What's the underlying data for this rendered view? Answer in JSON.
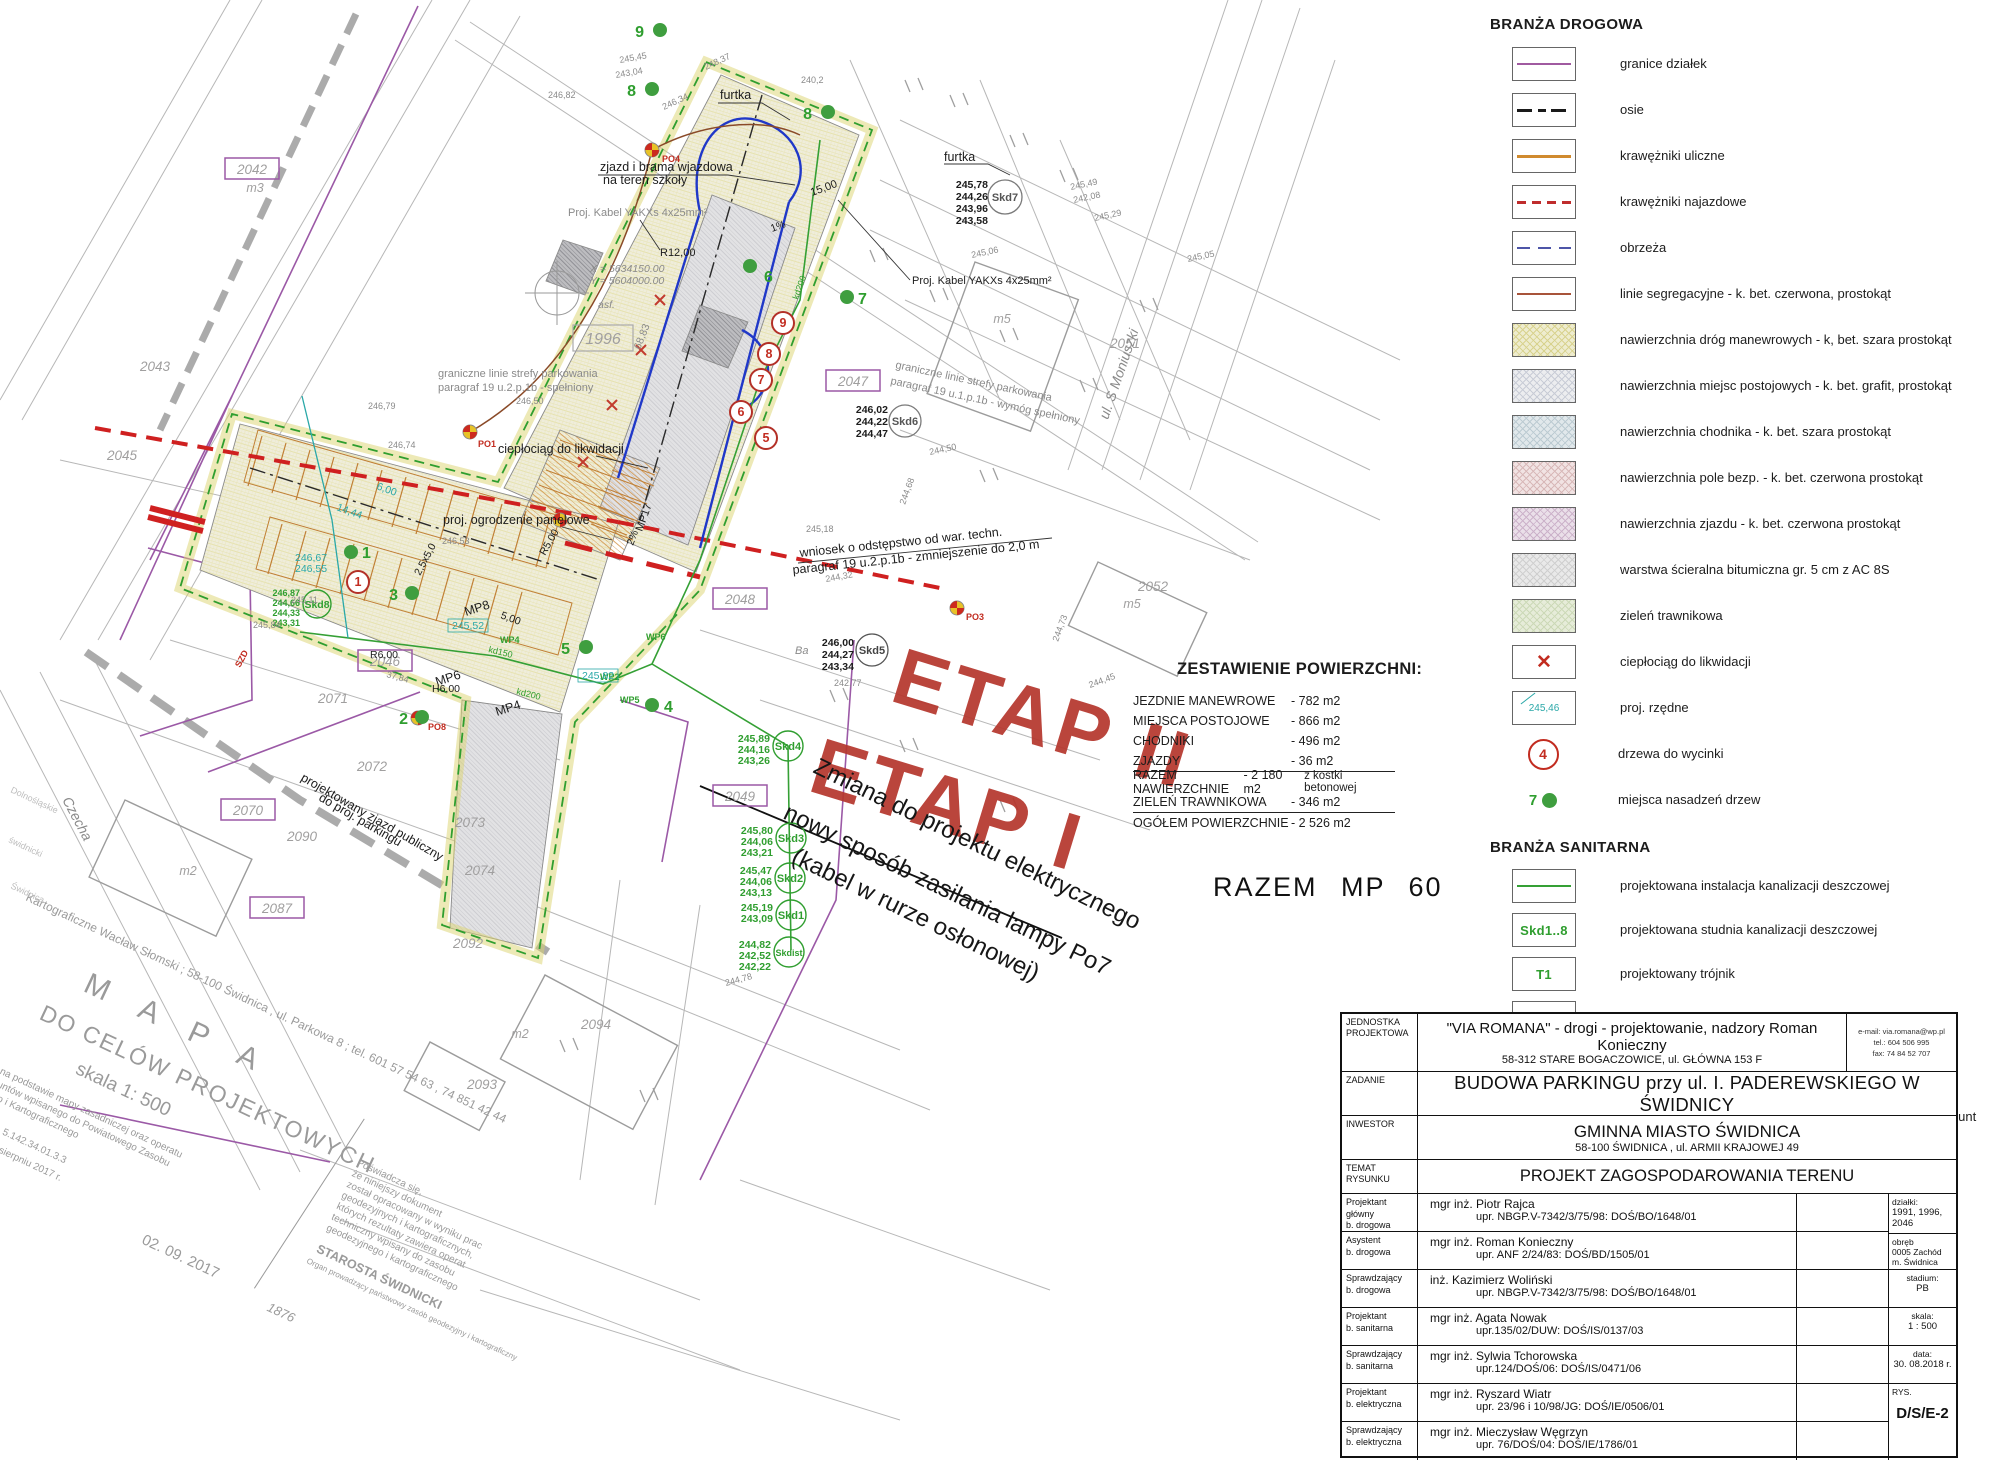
{
  "colors": {
    "accent_red": "#b5372e",
    "green": "#2f9e2f",
    "teal": "#2aa8a8",
    "purple": "#9b59a6",
    "orange": "#cf8b3a",
    "blue": "#2038c8",
    "legend_red": "#c22c20"
  },
  "map": {
    "etap_labels": {
      "etap2": "ETAP II",
      "etap1": "ETAP I"
    },
    "change_note": [
      "Zmiana do projektu elektrycznego",
      "nowy sposób zasilania lampy Po7",
      "(kabel w rurze osłonowej)"
    ],
    "annotations": {
      "zjazd_brama_1": "zjazd i brama wjazdowa",
      "zjazd_brama_2": "na teren szkoły",
      "kabel1": "Proj. Kabel YAKXs 4x25mm²",
      "kabel2": "Proj. Kabel YAKXs 4x25mm²",
      "furtka1": "furtka",
      "furtka2": "furtka",
      "strefa1a": "graniczne linie strefy parkowania",
      "strefa1b": "paragraf 19 u.2.p.1b - spełniony",
      "strefa2a": "graniczne linie strefy parkowania",
      "strefa2b": "paragraf 19 u.1.p.1b - wymóg spełniony",
      "cieplociag": "ciepłociąg do likwidacji",
      "ogrodzenie": "proj. ogrodzenie panelowe",
      "wniosek1": "wniosek o odstępstwo od war. techn.",
      "wniosek2": "paragraf 19 u.2.p.1b - zmniejszenie do 2,0 m",
      "zjazd_publiczny1": "projektowany zjazd publiczny",
      "zjazd_publiczny2": "do proj. parkingu",
      "coord_x": "X = 5634150.00",
      "coord_y": "Y = 5604000.00",
      "r12": "R12,00",
      "r5": "R5,00",
      "r6": "R6,00",
      "h6": "H6,00",
      "d3784": "37,84",
      "asf": "asf.",
      "dim68": "68,83",
      "dim15": "15,00",
      "grade1": "1%",
      "grade2": "2%",
      "stall_dim": "2,5x5,0",
      "stall_dim2": "5,00",
      "street_moniuszki": "ul. S Moniuszki",
      "street_czecha": "Czecha",
      "mp8": "MP8",
      "mp6": "MP6",
      "mp4": "MP4",
      "mp17": "MP17",
      "kd150": "kd150",
      "kd200": "kd200",
      "kd200b": "kd200",
      "wp2": "WP2",
      "wp4": "WP4",
      "wp5": "WP5",
      "wp6": "WP6",
      "po1": "PO1",
      "po3": "PO3",
      "po4": "PO4",
      "po8": "PO8",
      "szd": "SZD",
      "ba": "Ba",
      "e242": "242,77"
    },
    "parcels": {
      "p1996": "1996",
      "p2042": "2042",
      "p2043": "2043",
      "p2045": "2045",
      "p2046": "2046",
      "p2047": "2047",
      "p2048": "2048",
      "p2049": "2049",
      "p2051": "2051",
      "p2052": "2052",
      "p2070": "2070",
      "p2071": "2071",
      "p2072": "2072",
      "p2073": "2073",
      "p2074": "2074",
      "p2087": "2087",
      "p2090": "2090",
      "p2092": "2092",
      "p2093": "2093",
      "p2094": "2094"
    },
    "buildings": {
      "m2": "m2",
      "m2b": "m2",
      "m3": "m3",
      "m5": "m5",
      "m5b": "m5"
    },
    "skd": {
      "skd8": {
        "name": "Skd8",
        "v": [
          "246,87",
          "244,66",
          "244,33",
          "243,31"
        ]
      },
      "skd7": {
        "name": "Skd7",
        "v": [
          "245,78",
          "244,26",
          "243,96",
          "243,58"
        ]
      },
      "skd6": {
        "name": "Skd6",
        "v": [
          "246,02",
          "244,22",
          "244,47"
        ]
      },
      "skd5": {
        "name": "Skd5",
        "v": [
          "246,00",
          "244,27",
          "243,34"
        ]
      },
      "skd4": {
        "name": "Skd4",
        "v": [
          "245,89",
          "244,16",
          "243,26"
        ]
      },
      "skd3": {
        "name": "Skd3",
        "v": [
          "245,80",
          "244,06",
          "243,21"
        ]
      },
      "skd2": {
        "name": "Skd2",
        "v": [
          "245,47",
          "244,06",
          "243,13"
        ]
      },
      "skd1": {
        "name": "Skd1",
        "v": [
          "245,19",
          "243,09"
        ]
      },
      "skdist": {
        "name": "Skdist",
        "v": [
          "244,82",
          "242,52",
          "242,22"
        ]
      }
    },
    "dots": {
      "d1": "1",
      "d2": "2",
      "d3": "3",
      "d4": "4",
      "d5": "5",
      "d6": "6",
      "d7": "7",
      "d8": "8",
      "d8b": "8",
      "d9": "9"
    },
    "trees": {
      "t1": "1",
      "t5": "5",
      "t6": "6",
      "t7": "7",
      "t8": "8",
      "t9": "9"
    },
    "teal": {
      "t1": "246,67",
      "t2": "246,55",
      "t3": "245,52",
      "t4": "245,82",
      "t5": "6,00",
      "t6": "14,44"
    },
    "micro": {
      "m1": "245,45",
      "m2": "243,04",
      "m3": "246,82",
      "m4": "246,34",
      "m5": "248,37",
      "m6": "240,2",
      "m7": "245,06",
      "m8": "245,49",
      "m9": "242,08",
      "m10": "245,29",
      "m11": "245,05",
      "m12": "245,18",
      "m13": "244,32",
      "m14": "244,45",
      "m15": "244,73",
      "m16": "246,50",
      "m17": "246,79",
      "m18": "246,74",
      "m19": "246,53",
      "m20": "245,11",
      "m21": "245,84",
      "m22": "244,78",
      "m23": "244,50",
      "m24": "244,68"
    },
    "stamp": {
      "surveyor": "Kartograficzne Wacław Słomski  ;  58-100 Świdnica , ul. Parkowa 8  ;  tel. 601 57 54 63 , 74 851 42 44",
      "mapa": "M A P A",
      "cel": "DO CELÓW PROJEKTOWYCH",
      "skala": "skala 1: 500",
      "note1": "Wykonano na podstawie mapy zasadniczej oraz operatu",
      "note2": "ewidencji gruntów wpisanego do Powiatowego Zasobu",
      "note3": "Geodezyjnego i Kartograficznego",
      "note4": "Arkusz mapy:",
      "note5": "5.142.33.01.3.3 , 5.142.34.01.3.3",
      "note6": "Zaktualizowano w sierpniu 2017 r.",
      "posw1": "Poświadcza się,",
      "posw2": "że niniejszy dokument",
      "posw3": "został opracowany w wyniku prac",
      "posw4": "geodezyjnych i kartograficznych,",
      "posw5": "których rezultaty zawiera operat",
      "posw6": "techniczny wpisany do zasobu",
      "posw7": "geodezyjnego i kartograficznego",
      "starosta": "STAROSTA ŚWIDNICKI",
      "organ": "Organ prowadzący państwowy zasób geodezyjny i kartograficzny",
      "date_stamp": "02. 09. 2017",
      "num_stamp": "1876",
      "side1": "Dolnośląskie",
      "side2": "świdnicki",
      "side3": "Świdnica"
    }
  },
  "area_table": {
    "title": "ZESTAWIENIE POWIERZCHNI:",
    "rows": [
      {
        "label": "JEZDNIE MANEWROWE",
        "value": "- 782 m2",
        "extra": ""
      },
      {
        "label": "MIEJSCA POSTOJOWE",
        "value": "- 866 m2",
        "extra": ""
      },
      {
        "label": "CHODNIKI",
        "value": "- 496 m2",
        "extra": ""
      },
      {
        "label": "ZJAZDY",
        "value": "-   36 m2",
        "extra": ""
      },
      {
        "label": "RAZEM NAWIERZCHNIE",
        "value": "- 2 180 m2",
        "extra": "z kostki betonowej"
      },
      {
        "label": "ZIELEŃ TRAWNIKOWA",
        "value": "- 346 m2",
        "extra": ""
      },
      {
        "label": "OGÓŁEM POWIERZCHNIE",
        "value": "- 2 526 m2",
        "extra": ""
      }
    ],
    "razem": "RAZEM MP 60"
  },
  "legend": {
    "road": {
      "title": "BRANŻA DROGOWA",
      "items": [
        {
          "label": "granice działek"
        },
        {
          "label": "osie"
        },
        {
          "label": "krawężniki uliczne"
        },
        {
          "label": "krawężniki najazdowe"
        },
        {
          "label": "obrzeża"
        },
        {
          "label": "linie segregacyjne - k. bet. czerwona, prostokąt"
        },
        {
          "label": "nawierzchnia dróg manewrowych - k, bet. szara prostokąt"
        },
        {
          "label": "nawierzchnia miejsc postojowych - k. bet. grafit, prostokąt"
        },
        {
          "label": "nawierzchnia chodnika - k. bet. szara prostokąt"
        },
        {
          "label": "nawierzchnia  pole bezp. - k. bet. czerwona prostokąt"
        },
        {
          "label": "nawierzchnia  zjazdu - k. bet. czerwona prostokąt"
        },
        {
          "label": "warstwa ścieralna bitumiczna gr. 5 cm  z AC 8S"
        },
        {
          "label": "zieleń trawnikowa"
        },
        {
          "label": "ciepłociąg do likwidacji",
          "symbol": "✕"
        },
        {
          "label": "proj. rzędne",
          "symbol": "245,46"
        },
        {
          "label": "drzewa do wycinki",
          "symbol": "4"
        },
        {
          "label": "miejsca nasadzeń drzew",
          "symbol": "7"
        }
      ]
    },
    "sanitary": {
      "title": "BRANŻA SANITARNA",
      "items": [
        {
          "label": "projektowana instalacja kanalizacji deszczowej"
        },
        {
          "label": "projektowana studnia kanalizacji deszczowej",
          "symbol": "Skd1..8"
        },
        {
          "label": "projektowany trójnik",
          "symbol": "T1"
        },
        {
          "label": "projektowany wpust uliczny",
          "symbol": "WP1..WP12"
        }
      ]
    },
    "electrical": {
      "title": "BRANŻA ELEKTROENERGETYCZNA",
      "items": [
        {
          "label1": "Projektowana oprawa LED o mocy 31W.",
          "label2": "Słup aluminiowy prosty o wysokości 7,0m wkopywany w grunt"
        },
        {
          "label": "Projektowany kabel YAKXs 4x25mm"
        }
      ]
    }
  },
  "title_block": {
    "unit": {
      "label": "JEDNOSTKA PROJEKTOWA",
      "line1": "\"VIA ROMANA\" - drogi - projektowanie, nadzory Roman Konieczny",
      "line2": "58-312 STARE BOGACZOWICE, ul. GŁÓWNA 153 F",
      "contact1": "e-mail: via.romana@wp.pl",
      "contact2": "tel.: 604 506 995",
      "contact3": "fax: 74 84 52 707"
    },
    "task": {
      "label": "ZADANIE",
      "text": "BUDOWA PARKINGU przy ul. I. PADEREWSKIEGO W ŚWIDNICY"
    },
    "investor": {
      "label": "INWESTOR",
      "line1": "GMINNA MIASTO ŚWIDNICA",
      "line2": "58-100  ŚWIDNICA , ul. ARMII KRAJOWEJ 49"
    },
    "subject": {
      "label": "TEMAT RYSUNKU",
      "text": "PROJEKT ZAGOSPODAROWANIA TERENU"
    },
    "people": [
      {
        "role_a": "Projektant główny",
        "role_b": "b. drogowa",
        "name": "mgr inż. Piotr Rajca",
        "cert": "upr. NBGP.V-7342/3/75/98: DOŚ/BO/1648/01"
      },
      {
        "role_a": "Asystent",
        "role_b": "b. drogowa",
        "name": "mgr inż. Roman Konieczny",
        "cert": "upr. ANF 2/24/83: DOŚ/BD/1505/01"
      },
      {
        "role_a": "Sprawdzający",
        "role_b": "b. drogowa",
        "name": "inż. Kazimierz Woliński",
        "cert": "upr. NBGP.V-7342/3/75/98: DOŚ/BO/1648/01"
      },
      {
        "role_a": "Projektant",
        "role_b": "b. sanitarna",
        "name": "mgr inż. Agata Nowak",
        "cert": "upr.135/02/DUW: DOŚ/IS/0137/03"
      },
      {
        "role_a": "Sprawdzający",
        "role_b": "b. sanitarna",
        "name": "mgr inż. Sylwia Tchorowska",
        "cert": "upr.124/DOŚ/06: DOŚ/IS/0471/06"
      },
      {
        "role_a": "Projektant",
        "role_b": "b. elektryczna",
        "name": "mgr inż. Ryszard Wiatr",
        "cert": "upr. 23/96 i 10/98/JG: DOŚ/IE/0506/01"
      },
      {
        "role_a": "Sprawdzający",
        "role_b": "b. elektryczna",
        "name": "mgr inż. Mieczysław Węgrzyn",
        "cert": "upr. 76/DOŚ/04: DOŚ/IE/1786/01"
      }
    ],
    "meta": {
      "dzialki_label": "działki:",
      "dzialki": "1991, 1996, 2046",
      "obreb_label": "obręb",
      "obreb1": "0005 Zachód",
      "obreb2": "m. Świdnica",
      "stadium_label": "stadium:",
      "stadium": "PB",
      "skala_label": "skala:",
      "skala": "1 : 500",
      "data_label": "data:",
      "data": "30. 08.2018 r.",
      "rys_label": "RYS.",
      "rys": "D/S/E-2"
    }
  }
}
